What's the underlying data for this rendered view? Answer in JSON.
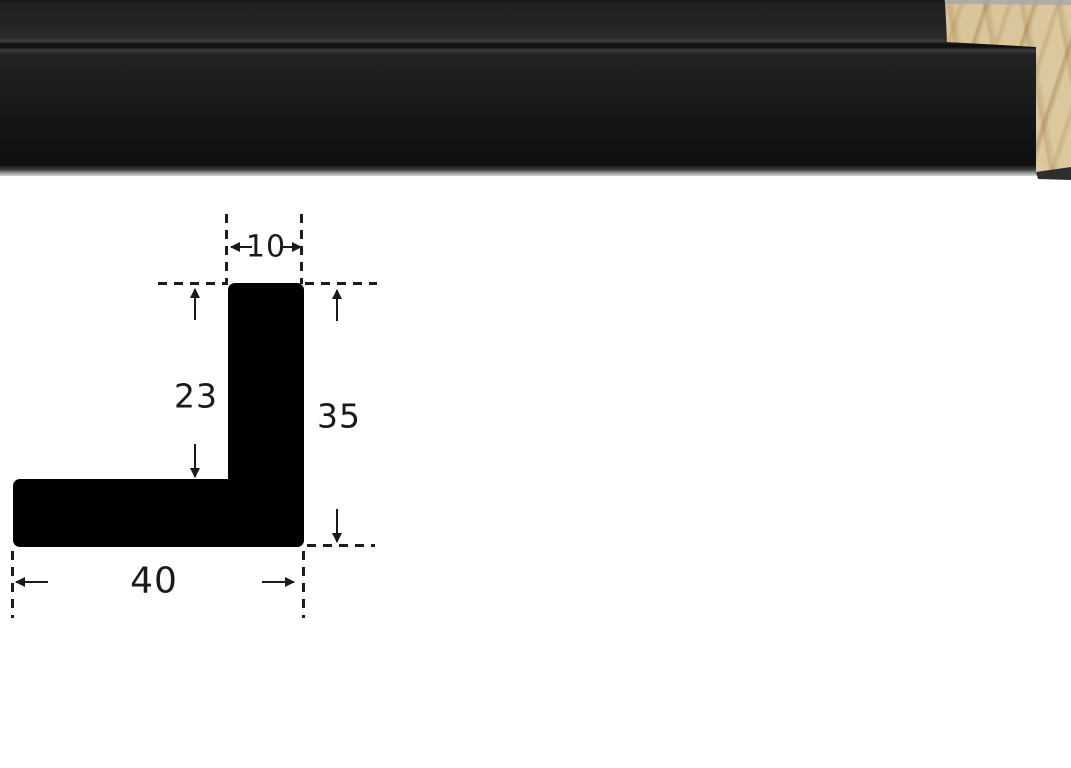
{
  "photo": {
    "subject": "black-picture-frame-moulding-length-with-exposed-wood-end",
    "colors": {
      "moulding": "#161616",
      "wood": "#dbc99e",
      "bottom_highlight": "#9a9a9a"
    }
  },
  "diagram": {
    "subject": "moulding-cross-section-profile",
    "colors": {
      "shape": "#000000",
      "lines": "#1c1c1c"
    },
    "dimensions": {
      "top_width": "10",
      "upper_height": "23",
      "total_height": "35",
      "base_width": "40"
    }
  }
}
